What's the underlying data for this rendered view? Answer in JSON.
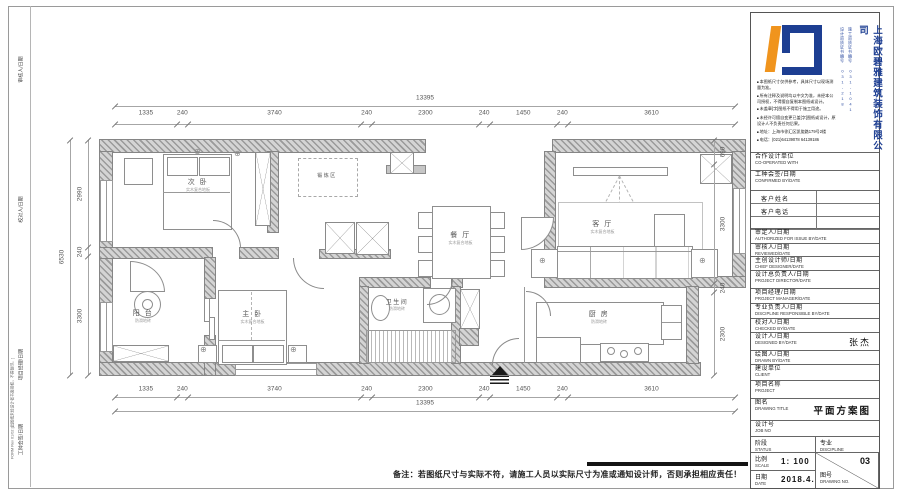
{
  "sheet": {
    "margin": {
      "form_text": "FORM Rev 01/02 [此图纸未经设计者书面授权，不得复印。]",
      "slots": [
        "审核人/日期",
        "校对人/日期",
        "项目经理/日期",
        "工种会签/日期"
      ]
    },
    "footer_note": "备注：若图纸尺寸与实际不符，请施工人员以实际尺寸为准或通知设计师，否则承担相应责任！"
  },
  "company": {
    "name": "上海欧碧雅建筑装饰有限公司",
    "license_left": "设计资质证书编号 031-218",
    "license_right": "施工资质证书编号 031-1041",
    "colors": {
      "blue": "#1d3e92",
      "orange": "#f0941d"
    },
    "notes": [
      "本图纸尺寸仅供参考，具体尺寸以现场测量为准。",
      "所有注释及说明均以中文为准，未经本公司授权，不得擅自复制本图纸或设计。",
      "未盖章[字]图纸不得用于施工用途。",
      "未经许可擅自变更已盖[字]图纸或设计，原设计人不负责任何后果。",
      "地址：上海市徐汇区凯旋路179号2楼",
      "电话：(021)64139078 64139186"
    ]
  },
  "titleblock": {
    "rows1": [
      {
        "cn": "合作设计单位",
        "en": "CO-OPERATED WITH"
      },
      {
        "cn": "工种会签/日期",
        "en": "CONFIRMED BY/DATE"
      }
    ],
    "client_rows": [
      "客户姓名",
      "客户电话"
    ],
    "rows2": [
      {
        "cn": "审定人/日期",
        "en": "AUTHORIZED FOR ISSUE BY/DATE"
      },
      {
        "cn": "审核人/日期",
        "en": "REVIEWED/DATE"
      },
      {
        "cn": "主创设计师/日期",
        "en": "CHIEF DESIGNER/DATE"
      },
      {
        "cn": "设计总负责人/日期",
        "en": "PROJECT DIRECTOR/DATE"
      },
      {
        "cn": "项目经理/日期",
        "en": "PROJECT MANAGER/DATE"
      },
      {
        "cn": "专业负责人/日期",
        "en": "DISCIPLINE RESPONSIBLE BY/DATE"
      },
      {
        "cn": "校对人/日期",
        "en": "CHECKED BY/DATE"
      },
      {
        "cn": "设计人/日期",
        "en": "DESIGNED BY/DATE",
        "value": "张杰"
      },
      {
        "cn": "绘图人/日期",
        "en": "DRAWN BY/DATE"
      },
      {
        "cn": "建设单位",
        "en": "CLIENT"
      },
      {
        "cn": "项目名称",
        "en": "PROJECT"
      },
      {
        "cn": "图名",
        "en": "DRAWING TITLE",
        "value": "平面方案图"
      },
      {
        "cn": "设计号",
        "en": "JOB NO"
      }
    ],
    "grid": {
      "status_cn": "阶段",
      "status_en": "STATUS",
      "discipline_cn": "专业",
      "discipline_en": "DISCIPLINE",
      "scale_cn": "比例",
      "scale_en": "SCALE",
      "scale_value": "1: 100",
      "no_cn": "图号",
      "no_en": "DRAWING NO.",
      "no_value": "03",
      "date_cn": "日期",
      "date_en": "DATE",
      "date_value": "2018.4.17"
    }
  },
  "plan": {
    "rooms": [
      {
        "name": "次 卧",
        "sub": "实木复合地板"
      },
      {
        "name": "锻炼区",
        "sub": ""
      },
      {
        "name": "餐 厅",
        "sub": "实木复合地板"
      },
      {
        "name": "客 厅",
        "sub": "实木复合地板"
      },
      {
        "name": "阳 台",
        "sub": "防滑地砖"
      },
      {
        "name": "主 卧",
        "sub": "实木复合地板"
      },
      {
        "name": "卫生间",
        "sub": "防滑地砖"
      },
      {
        "name": "厨 房",
        "sub": "防滑地砖"
      }
    ],
    "dims": {
      "top": {
        "vals": [
          1335,
          240,
          3740,
          240,
          2300,
          240,
          1450,
          240,
          3610
        ],
        "total": "13395"
      },
      "bottom": {
        "vals": [
          1335,
          240,
          3740,
          240,
          2300,
          240,
          1450,
          240,
          3610
        ],
        "total": "13395"
      },
      "left": {
        "vals": [
          2990,
          240,
          3300
        ],
        "total": "6530"
      },
      "right": {
        "vals": [
          690,
          3300,
          240,
          2300
        ]
      }
    }
  }
}
